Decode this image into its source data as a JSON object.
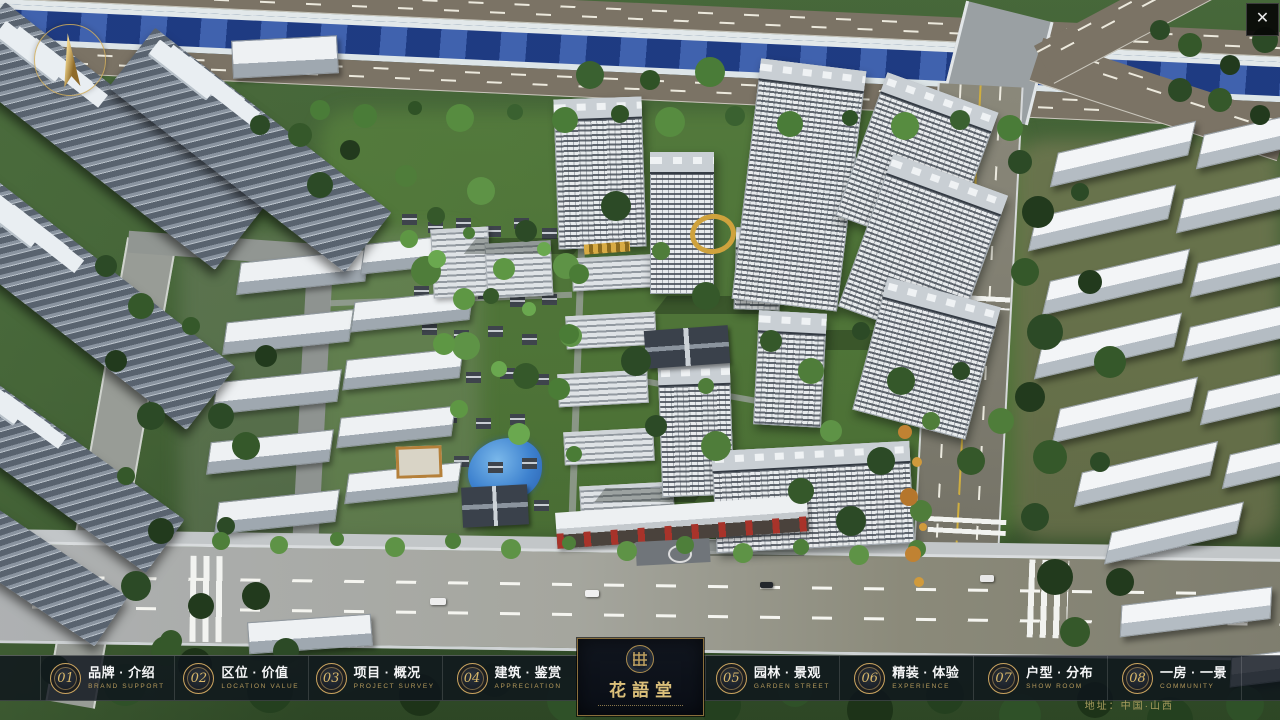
{
  "window": {
    "close_glyph": "✕"
  },
  "project": {
    "logo_title": "花語堂",
    "address": "地址：中国·山西"
  },
  "nav": {
    "items": [
      {
        "num": "01",
        "zh": "品牌 · 介绍",
        "en": "BRAND SUPPORT"
      },
      {
        "num": "02",
        "zh": "区位 · 价值",
        "en": "LOCATION VALUE"
      },
      {
        "num": "03",
        "zh": "项目 · 概况",
        "en": "PROJECT SURVEY"
      },
      {
        "num": "04",
        "zh": "建筑 · 鉴赏",
        "en": "APPRECIATION"
      },
      {
        "num": "05",
        "zh": "园林 · 景观",
        "en": "GARDEN STREET"
      },
      {
        "num": "06",
        "zh": "精装 · 体验",
        "en": "EXPERIENCE"
      },
      {
        "num": "07",
        "zh": "户型 · 分布",
        "en": "SHOW ROOM"
      },
      {
        "num": "08",
        "zh": "一房 · 一景",
        "en": "COMMUNITY"
      }
    ]
  },
  "colors": {
    "gold": "#c9a560",
    "bar_bg": "rgba(14,20,28,0.82)",
    "river": "#27489a"
  }
}
